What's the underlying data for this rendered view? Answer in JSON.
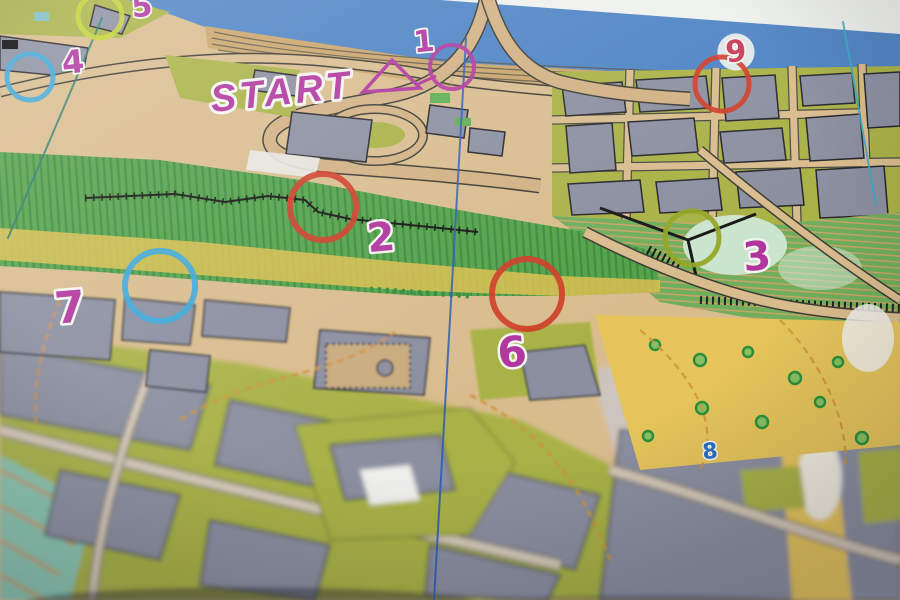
{
  "scene": {
    "description": "Photograph of a sprint orienteering paper map with colored numbered control circles",
    "start_label": "START"
  },
  "palette": {
    "paper": "#eff1ee",
    "water": "#4d83c4",
    "land": "#d9bc8e",
    "building": "#8b8fa0",
    "olive": "#a9b246",
    "field_green": "#54a24a",
    "hill_green": "#6fae5c",
    "yellow_open": "#e5c45b",
    "plaza": "#cdc5bd",
    "teal": "#8ac6b1",
    "canopy": "#cfe8d4",
    "magenta": "#b0369e",
    "red": "#cf3d28",
    "blue": "#3ba7da",
    "yellow_green": "#c3d232",
    "olive_circle": "#94a623",
    "rose": "#c93a55",
    "blue_number": "#2b6fc2",
    "north_blue": "#2b5cb8",
    "north_cyan": "#3aa9c9",
    "north_teal": "#2a7a6e",
    "contour_orange": "#cf9340"
  },
  "course": {
    "start_triangle": {
      "points": "392,60 363,92 420,88",
      "color": "magenta"
    },
    "connector": {
      "x1": 418,
      "y1": 84,
      "x2": 436,
      "y2": 76,
      "color": "magenta"
    },
    "controls": [
      {
        "number": "1",
        "circle_color": "magenta",
        "cx": 452,
        "cy": 67,
        "r": 22,
        "stroke": 4,
        "nx": 424,
        "ny": 42,
        "ncolor": "magenta",
        "nsize": 30
      },
      {
        "number": "2",
        "circle_color": "red",
        "cx": 323,
        "cy": 207,
        "r": 33,
        "stroke": 6,
        "nx": 381,
        "ny": 238,
        "ncolor": "magenta",
        "nsize": 40
      },
      {
        "number": "3",
        "circle_color": "olive_circle",
        "cx": 692,
        "cy": 238,
        "r": 27,
        "stroke": 5,
        "nx": 757,
        "ny": 257,
        "ncolor": "magenta",
        "nsize": 40
      },
      {
        "number": "4",
        "circle_color": "blue",
        "cx": 30,
        "cy": 77,
        "r": 23,
        "stroke": 5,
        "nx": 73,
        "ny": 62,
        "ncolor": "magenta",
        "nsize": 32
      },
      {
        "number": "5",
        "circle_color": "yellow_green",
        "cx": 100,
        "cy": 16,
        "r": 22,
        "stroke": 5,
        "nx": 142,
        "ny": 7,
        "ncolor": "magenta",
        "nsize": 30
      },
      {
        "number": "6",
        "circle_color": "red",
        "cx": 527,
        "cy": 294,
        "r": 35,
        "stroke": 6,
        "nx": 512,
        "ny": 352,
        "ncolor": "magenta",
        "nsize": 42
      },
      {
        "number": "7",
        "circle_color": "blue",
        "cx": 160,
        "cy": 286,
        "r": 35,
        "stroke": 6,
        "nx": 70,
        "ny": 308,
        "ncolor": "magenta",
        "nsize": 44
      },
      {
        "number": "8",
        "circle_color": null,
        "nx": 710,
        "ny": 452,
        "ncolor": "blue_number",
        "nsize": 22
      },
      {
        "number": "9",
        "circle_color": "red",
        "cx": 722,
        "cy": 84,
        "r": 27,
        "stroke": 5,
        "nx": 736,
        "ny": 52,
        "ncolor": "rose",
        "nsize": 30,
        "halo": true
      }
    ]
  },
  "north_lines": [
    {
      "x1": 466,
      "y1": 38,
      "x2": 434,
      "y2": 600,
      "color": "north_blue"
    },
    {
      "x1": 843,
      "y1": 22,
      "x2": 876,
      "y2": 205,
      "color": "north_cyan"
    },
    {
      "x1": 102,
      "y1": 18,
      "x2": 8,
      "y2": 238,
      "color": "north_teal"
    }
  ]
}
